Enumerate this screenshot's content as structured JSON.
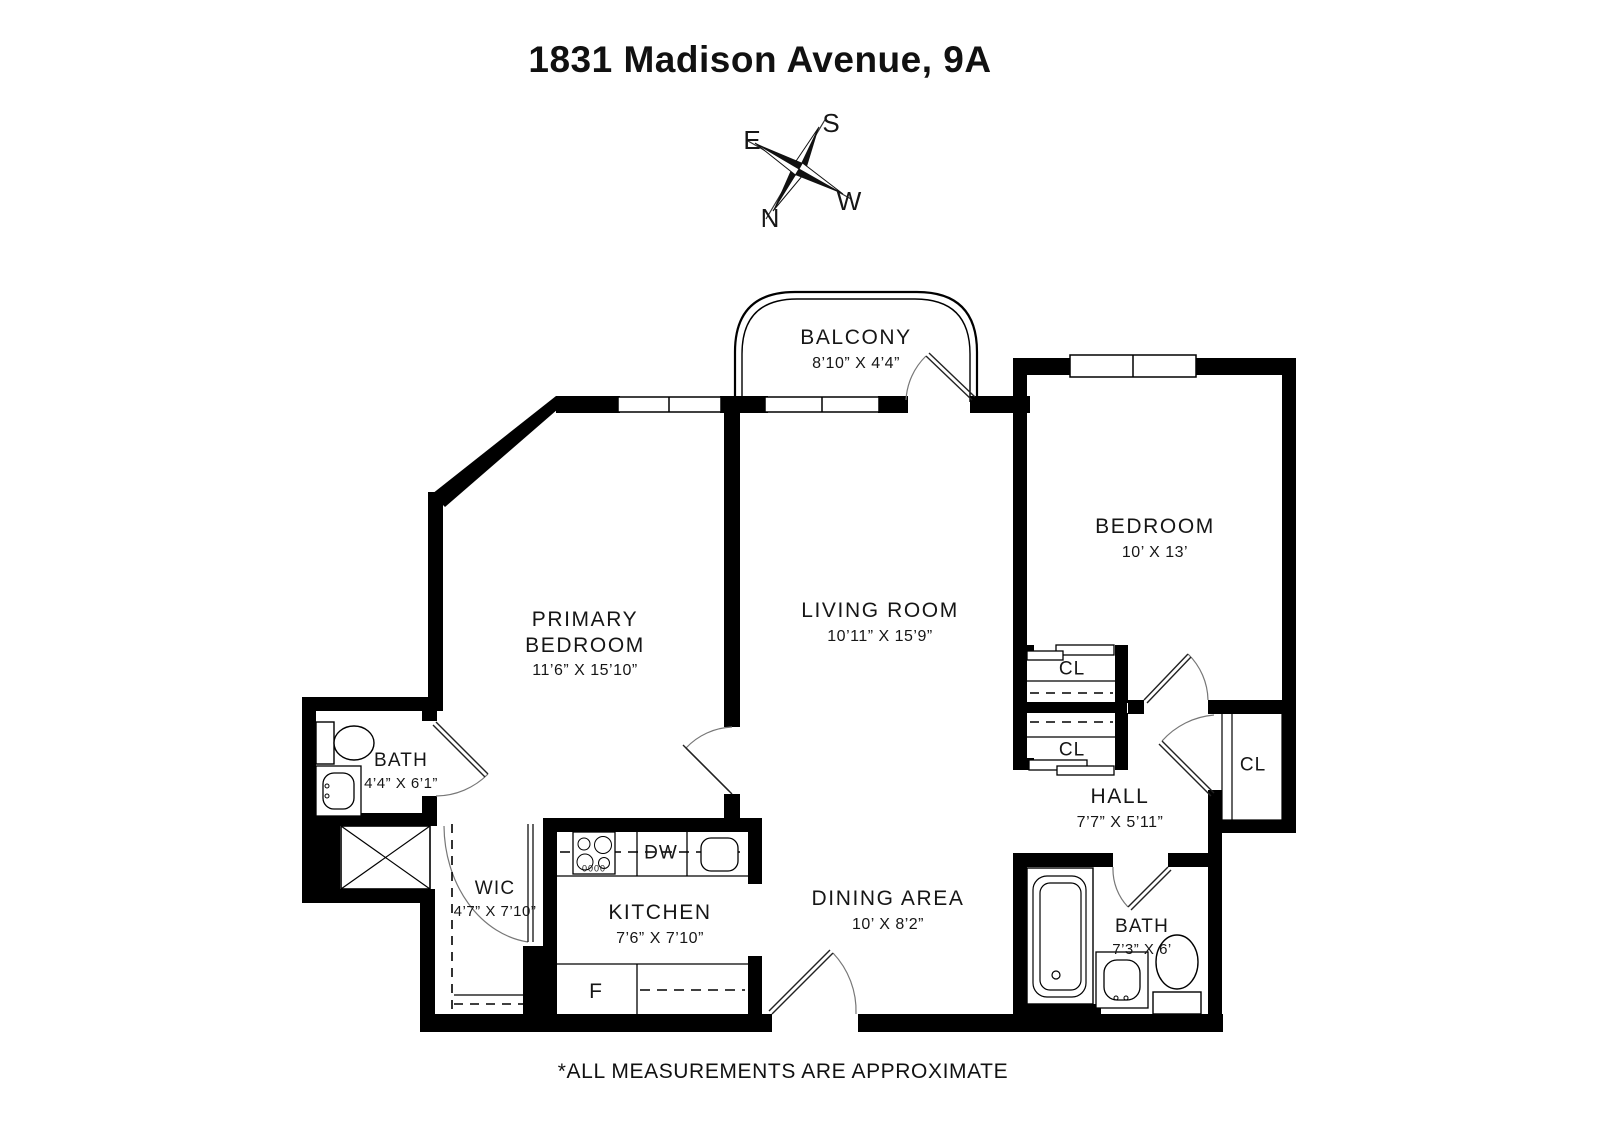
{
  "title": "1831 Madison Avenue, 9A",
  "footer": "*ALL MEASUREMENTS ARE APPROXIMATE",
  "compass": {
    "n": "N",
    "s": "S",
    "e": "E",
    "w": "W"
  },
  "rooms": {
    "balcony": {
      "name": "BALCONY",
      "dims": "8’10” X 4’4”"
    },
    "living_room": {
      "name": "LIVING ROOM",
      "dims": "10’11” X 15’9”"
    },
    "primary_bedroom": {
      "name": "PRIMARY BEDROOM",
      "dims": "11’6” X 15’10”"
    },
    "bedroom": {
      "name": "BEDROOM",
      "dims": "10’ X 13’"
    },
    "bath_primary": {
      "name": "BATH",
      "dims": "4’4” X 6’1”"
    },
    "wic": {
      "name": "WIC",
      "dims": "4’7” X 7’10”"
    },
    "kitchen": {
      "name": "KITCHEN",
      "dims": "7’6” X 7’10”"
    },
    "dining_area": {
      "name": "DINING AREA",
      "dims": "10’ X 8’2”"
    },
    "hall": {
      "name": "HALL",
      "dims": "7’7” X 5’11”"
    },
    "bath_hall": {
      "name": "BATH",
      "dims": "7’3” X 6’"
    },
    "closet_top": {
      "label": "CL"
    },
    "closet_bottom": {
      "label": "CL"
    },
    "closet_hall": {
      "label": "CL"
    }
  },
  "appliances": {
    "dishwasher": "DW",
    "fridge": "F",
    "stove_knobs": "0000"
  },
  "colors": {
    "wall": "#000000",
    "thin_line": "#000000",
    "arc": "#666666"
  }
}
